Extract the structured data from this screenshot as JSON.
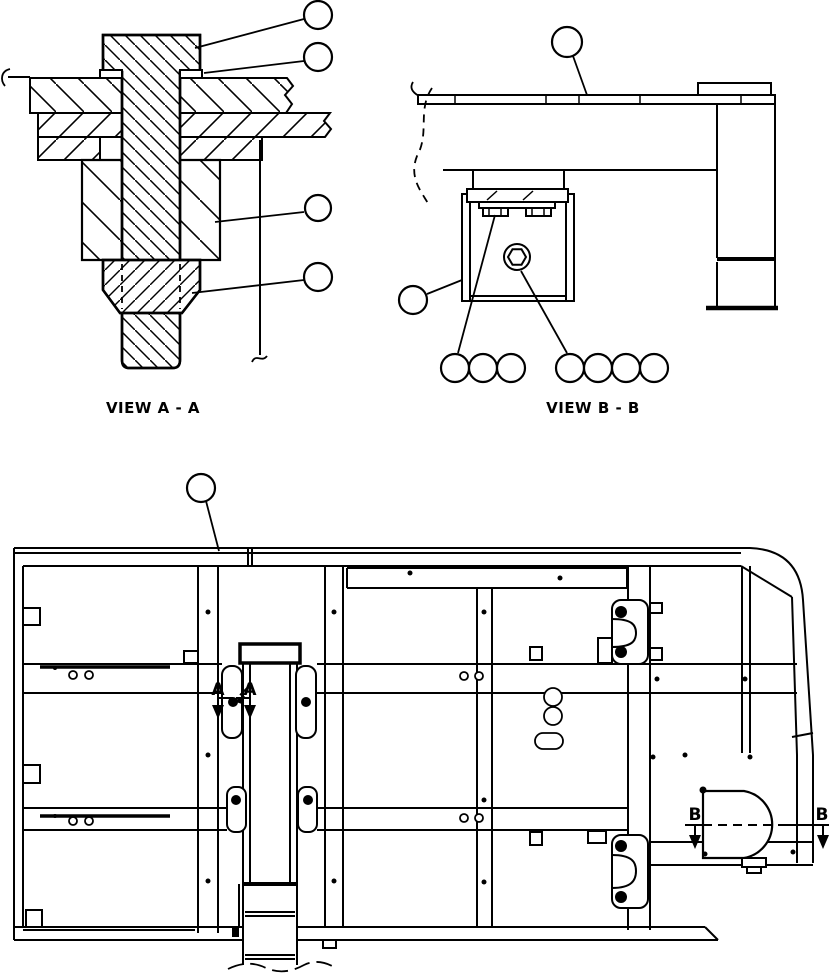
{
  "views": {
    "view_a": {
      "label": "VIEW A - A",
      "callouts": 4
    },
    "view_b": {
      "label": "VIEW B - B",
      "callouts": 9
    },
    "plan": {
      "callouts": 1
    }
  },
  "section_markers": {
    "a_left": "A",
    "a_right": "A",
    "b_left": "B",
    "b_right": "B"
  },
  "callout_label": "",
  "colors": {
    "line": "#000000",
    "background": "#ffffff"
  }
}
